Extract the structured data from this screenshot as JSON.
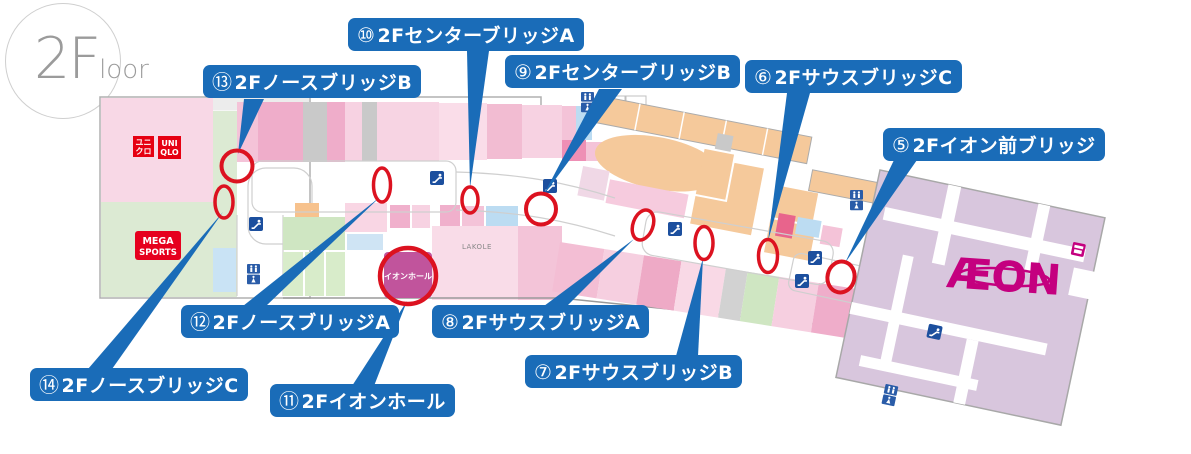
{
  "floor_badge": {
    "big": "2F",
    "small": "loor"
  },
  "bridge_labels": [
    {
      "number": "⑤",
      "name": "2Fイオン前ブリッジ"
    },
    {
      "number": "⑥",
      "name": "2FサウスブリッジC"
    },
    {
      "number": "⑦",
      "name": "2FサウスブリッジB"
    },
    {
      "number": "⑧",
      "name": "2FサウスブリッジA"
    },
    {
      "number": "⑨",
      "name": "2FセンターブリッジB"
    },
    {
      "number": "⑩",
      "name": "2FセンターブリッジA"
    },
    {
      "number": "⑪",
      "name": "2Fイオンホール"
    },
    {
      "number": "⑫",
      "name": "2FノースブリッジA"
    },
    {
      "number": "⑬",
      "name": "2FノースブリッジB"
    },
    {
      "number": "⑭",
      "name": "2FノースブリッジC"
    }
  ],
  "stores": {
    "uniqlo_jp_top": "ユニ",
    "uniqlo_jp_bottom": "クロ",
    "uniqlo_en_top": "UNI",
    "uniqlo_en_bottom": "QLO",
    "mega_sports_top": "MEGA",
    "mega_sports_bottom": "SPORTS",
    "lakole": "LAKOLE",
    "aeon_hall": "イオンホール",
    "aeon": "ÆON"
  },
  "icons": {
    "escalator": "escalator-icon",
    "restroom": "restroom-icon",
    "shop": "shop-icon"
  },
  "colors": {
    "label_blue": "#1a6cb8",
    "marker_red": "#dc1220",
    "uniqlo_red": "#e60012",
    "mega_red": "#e6001e",
    "aeon_magenta": "#c4007f",
    "aeon_hall_magenta": "#c1549c",
    "aeon_building": "#d8c6dd",
    "escalator_blue": "#1c4f9e",
    "restroom_blue": "#2a5ca8"
  }
}
